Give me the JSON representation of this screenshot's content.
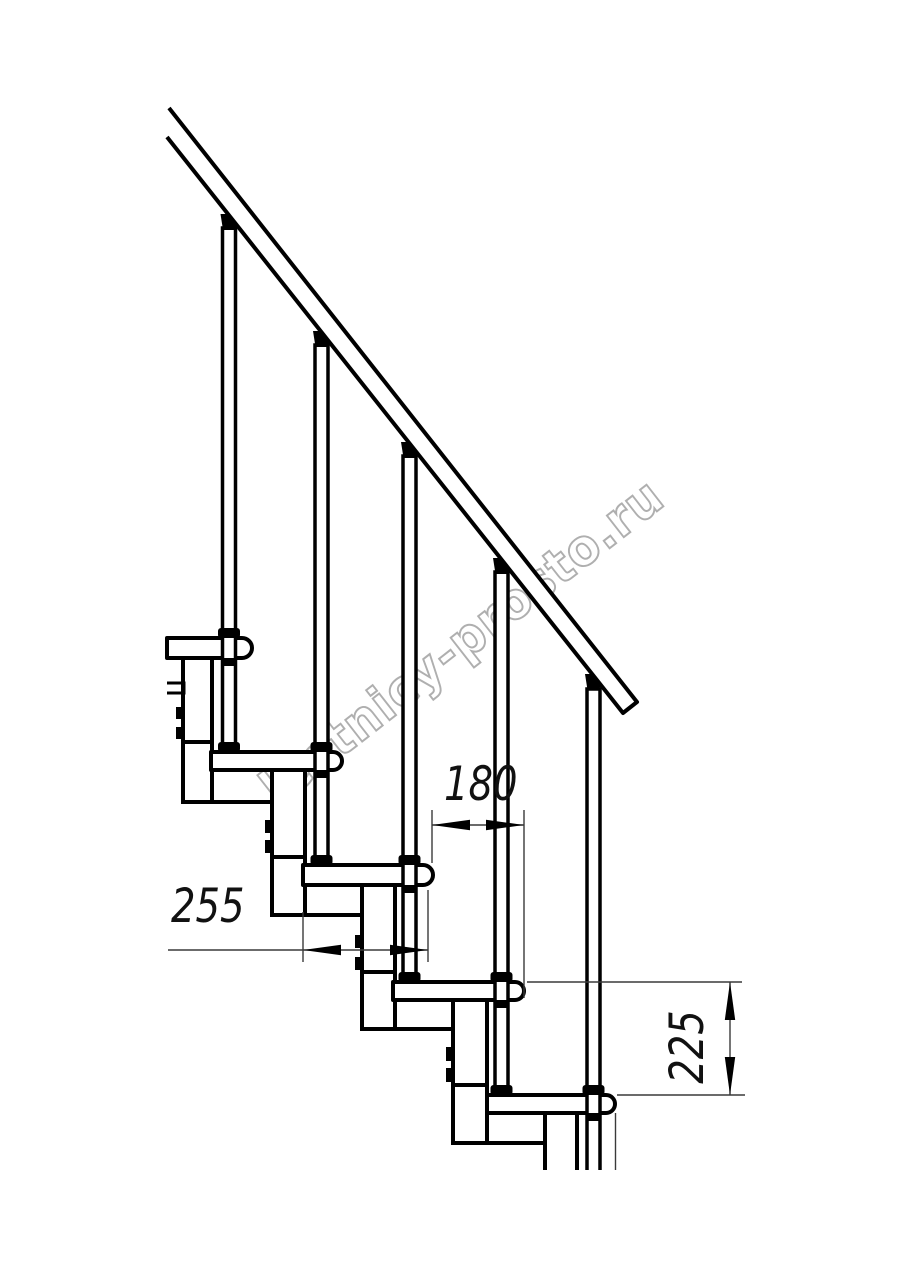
{
  "page": {
    "background": "#ffffff"
  },
  "drawing": {
    "dimension_labels": {
      "d180": "180",
      "d255": "255",
      "d225": "225"
    },
    "watermark": "lestnicy-prosto.ru",
    "line_color": "#000000",
    "thin_line_color": "#3a3a3a",
    "watermark_color": "#9c9c9c"
  }
}
